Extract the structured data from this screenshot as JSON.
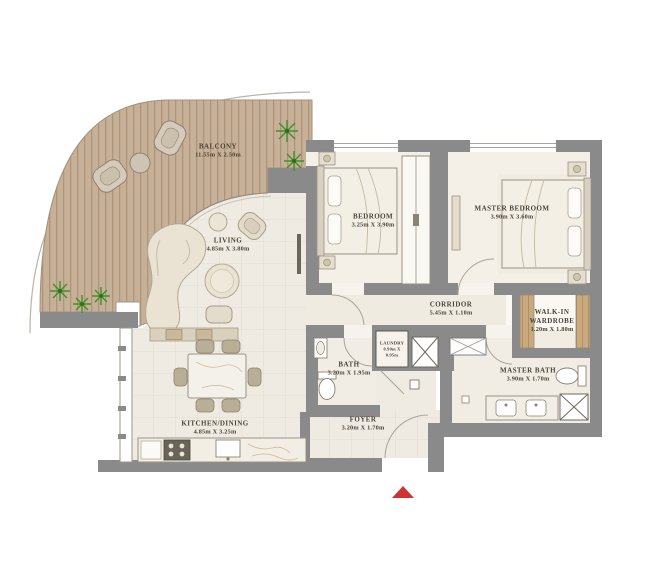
{
  "plan_type": "apartment-floor-plan",
  "rooms": {
    "balcony": {
      "name": "BALCONY",
      "dims": "11.55m X 2.50m"
    },
    "living": {
      "name": "LIVING",
      "dims": "4.85m X 3.80m"
    },
    "bedroom": {
      "name": "BEDROOM",
      "dims": "3.25m X 3.90m"
    },
    "master_bedroom": {
      "name": "MASTER BEDROOM",
      "dims": "3.90m X 3.60m"
    },
    "corridor": {
      "name": "CORRIDOR",
      "dims": "5.45m X 1.10m"
    },
    "wardrobe": {
      "name": "WALK-IN WARDROBE",
      "dims": "1.20m X 1.80m"
    },
    "bath": {
      "name": "BATH",
      "dims": "3.20m X 1.95m"
    },
    "laundry": {
      "name": "LAUNDRY",
      "dims": "0.90m X 0.95m"
    },
    "master_bath": {
      "name": "MASTER BATH",
      "dims": "3.90m X 1.70m"
    },
    "kitchen_dining": {
      "name": "KITCHEN/DINING",
      "dims": "4.85m X 3.25m"
    },
    "foyer": {
      "name": "FOYER",
      "dims": "3.20m X 1.70m"
    }
  },
  "entrance": {
    "marker": "red-triangle-up"
  },
  "colors": {
    "wall": "#8a8a8a",
    "deck": "#c7b098",
    "deck_stripe": "#ae9579",
    "floor": "#f0ebe2",
    "floor_bedroom": "#f4f0e8",
    "wood": "#c9a97e",
    "plant": "#4f9c31",
    "entrance_arrow": "#cf3330",
    "text": "#4a4238"
  }
}
